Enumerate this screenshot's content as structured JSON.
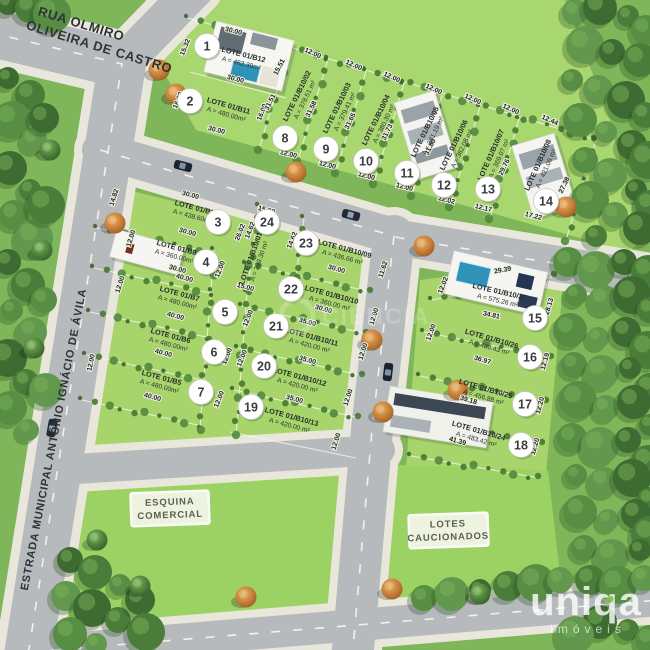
{
  "map": {
    "streets": [
      {
        "name_line1": "RUA OLMIRO",
        "name_line2": "OLIVEIRA DE CASTRO"
      },
      {
        "name": "ESTRADA MUNICIPAL ANTÔNIO IGNÁCIO DE ÁVILA"
      }
    ],
    "signs": [
      {
        "line1": "ESQUINA",
        "line2": "COMERCIAL"
      },
      {
        "line1": "LOTES",
        "line2": "CAUCIONADOS"
      }
    ],
    "lots": [
      {
        "num": "1",
        "code": "LOTE 01/B12",
        "area": "A = 462.39m²"
      },
      {
        "num": "2",
        "code": "LOTE 01/B11",
        "area": "A = 480.00m²"
      },
      {
        "num": "3",
        "code": "LOTE 01/B9",
        "area": "A = 438.60m²"
      },
      {
        "num": "4",
        "code": "LOTE 01/B8",
        "area": "A = 360.00m²"
      },
      {
        "num": "5",
        "code": "LOTE 01/B7",
        "area": "A = 480.00m²"
      },
      {
        "num": "6",
        "code": "LOTE 01/B6",
        "area": "A = 480.00m²"
      },
      {
        "num": "7",
        "code": "LOTE 01/B5",
        "area": "A = 480.00m²"
      },
      {
        "num": "8",
        "code": "LOTE 01/B10/02",
        "area": "A = 378.51 m²"
      },
      {
        "num": "9",
        "code": "LOTE 01/B10/03",
        "area": "A = 379.41 m²"
      },
      {
        "num": "10",
        "code": "LOTE 01/B10/04",
        "area": "A = 380.30 m²"
      },
      {
        "num": "11",
        "code": "LOTE 01/B10/05",
        "area": "A = 381.19 m²"
      },
      {
        "num": "12",
        "code": "LOTE 01/B10/06",
        "area": "A = 382.08 m²"
      },
      {
        "num": "13",
        "code": "LOTE 01/B10/07",
        "area": "A = 369.07 m²"
      },
      {
        "num": "14",
        "code": "LOTE 01/B10/08",
        "area": "A = 421.06 m²"
      },
      {
        "num": "15",
        "code": "LOTE 01/B10/27",
        "area": "A = 575.26 m²"
      },
      {
        "num": "16",
        "code": "LOTE 01/B10/26",
        "area": "A = 430.43 m²"
      },
      {
        "num": "17",
        "code": "LOTE 01/B10/25",
        "area": "A = 456.88 m²"
      },
      {
        "num": "18",
        "code": "LOTE 01/B10/24",
        "area": "A = 483.42 m²"
      },
      {
        "num": "19",
        "code": "LOTE 01/B10/13",
        "area": "A = 420.00 m²"
      },
      {
        "num": "20",
        "code": "LOTE 01/B10/12",
        "area": "A = 420.00 m²"
      },
      {
        "num": "21",
        "code": "LOTE 01/B10/11",
        "area": "A = 420.00 m²"
      },
      {
        "num": "22",
        "code": "LOTE 01/B10/10",
        "area": "A = 360.00 m²"
      },
      {
        "num": "23",
        "code": "LOTE 01/B10/09",
        "area": "A = 436.66 m²"
      },
      {
        "num": "24",
        "code": "LOTE 01/B10/01",
        "area": "A = 399.30 m²"
      }
    ],
    "dims": [
      "30.00",
      "15.32",
      "30.00",
      "16.00",
      "30.00",
      "16.00",
      "15.51",
      "12.00",
      "12.00",
      "12.00",
      "12.00",
      "12.00",
      "12.00",
      "12.44",
      "31.51",
      "31.58",
      "31.65",
      "31.73",
      "31.80",
      "29.76",
      "27.38",
      "12.00",
      "12.00",
      "12.00",
      "12.00",
      "12.02",
      "12.17",
      "17.22",
      "30.00",
      "14.82",
      "30.00",
      "26.02",
      "14.62",
      "30.00",
      "12.00",
      "12.00",
      "40.00",
      "15.00",
      "40.00",
      "12.00",
      "12.00",
      "40.00",
      "12.00",
      "40.00",
      "12.00",
      "15.00",
      "14.62",
      "11.62",
      "30.00",
      "30.00",
      "12.00",
      "35.00",
      "12.00",
      "12.00",
      "35.00",
      "12.00",
      "35.00",
      "12.00",
      "12.00",
      "29.39",
      "12.02",
      "34.81",
      "28.13",
      "12.00",
      "36.97",
      "12.19",
      "39.18",
      "12.20",
      "41.39",
      "12.20"
    ],
    "watermark": "CIÊNCIA",
    "logo": {
      "brand": "uniqa",
      "tagline": "imóveis"
    },
    "colors": {
      "field": "#a7d56c",
      "road": "#b7babd",
      "sidewalk": "#e9e7db",
      "forest": "#41702f",
      "tree_orange": "#cd8039",
      "pool": "#2f93b8"
    }
  }
}
